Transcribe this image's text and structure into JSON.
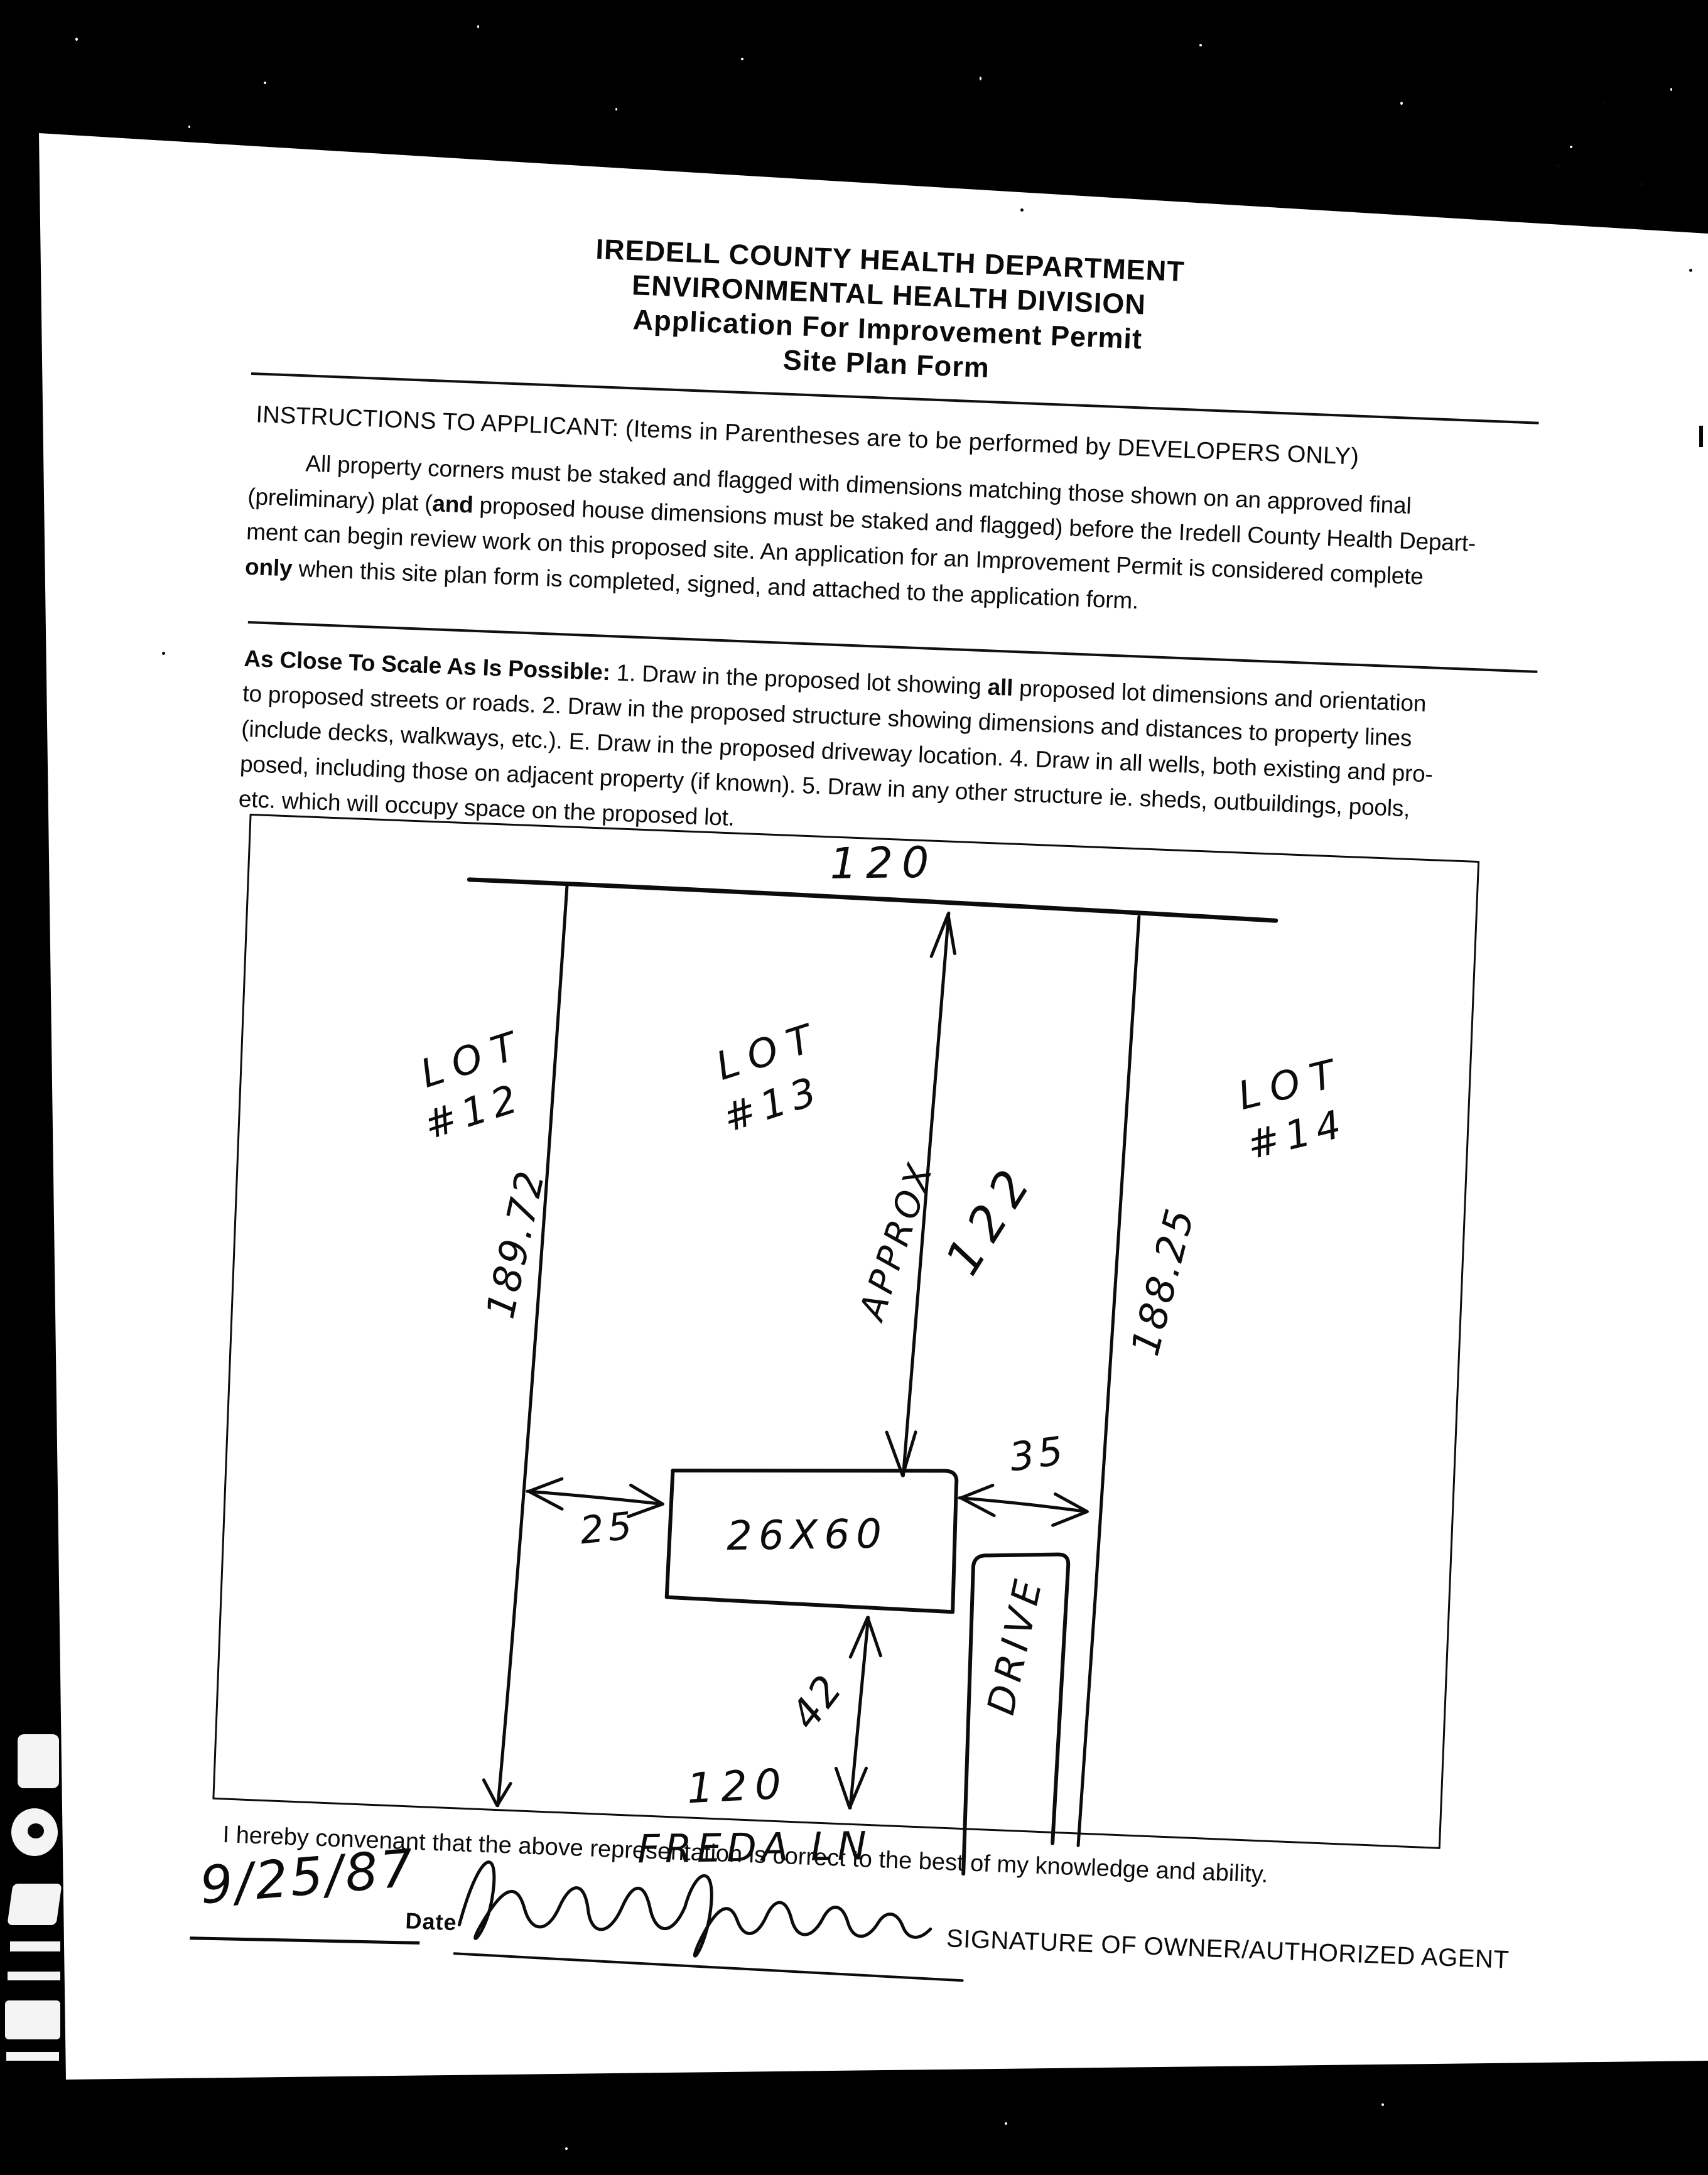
{
  "colors": {
    "background": "#000000",
    "paper": "#ffffff",
    "ink": "#0b0b0b"
  },
  "doc": {
    "header": {
      "line1": "IREDELL COUNTY HEALTH DEPARTMENT",
      "line2": "ENVIRONMENTAL HEALTH DIVISION",
      "line3": "Application For Improvement Permit",
      "line4": "Site Plan Form"
    },
    "instructions_heading": "INSTRUCTIONS TO APPLICANT: (Items in Parentheses are to be performed by DEVELOPERS ONLY)",
    "instructions_paragraph": {
      "line1": "All property corners must be staked and flagged with dimensions matching those shown on an approved final",
      "line2_pre": "(preliminary) plat (",
      "line2_bold": "and",
      "line2_post": " proposed house dimensions must be staked and flagged) before the Iredell County Health Depart-",
      "line3": "ment can begin review work on this proposed site. An application for an Improvement Permit is considered complete",
      "line4_bold": "only",
      "line4_post": " when this site plan form is completed, signed, and attached to the application form."
    },
    "scale_paragraph": {
      "line1_bold": "As Close To Scale As Is Possible:",
      "line1_mid": " 1. Draw in the proposed lot showing ",
      "line1_bold2": "all",
      "line1_post": " proposed lot dimensions and orientation",
      "line2": "to proposed streets or roads. 2. Draw in the proposed structure showing dimensions and distances to property lines",
      "line3": "(include decks, walkways, etc.). E. Draw in the proposed driveway location. 4. Draw in all wells, both existing and pro-",
      "line4": "posed, including those on adjacent property (if known). 5. Draw in any other structure ie. sheds, outbuildings, pools,",
      "line5": "etc. which will occupy space on the proposed lot."
    },
    "covenant": "I hereby convenant that the above representation is correct to the best of my knowledge and ability.",
    "signature": {
      "date_script": "9/25/87",
      "date_label": "Date",
      "caption": "SIGNATURE OF OWNER/AUTHORIZED AGENT"
    }
  },
  "site_plan": {
    "top_dimension": "120",
    "lots": [
      {
        "word": "LOT",
        "num": "#12"
      },
      {
        "word": "LOT",
        "num": "#13"
      },
      {
        "word": "LOT",
        "num": "#14"
      }
    ],
    "left_dim": "189.72",
    "right_dim": "188.25",
    "approx_label": "APPROX",
    "approx_value": "122",
    "house_label": "26X60",
    "offset_left": "25",
    "offset_right": "35",
    "offset_bottom": "42",
    "drive_label": "DRIVE",
    "bottom_dim": "120",
    "street_name": "FREDA LN"
  }
}
